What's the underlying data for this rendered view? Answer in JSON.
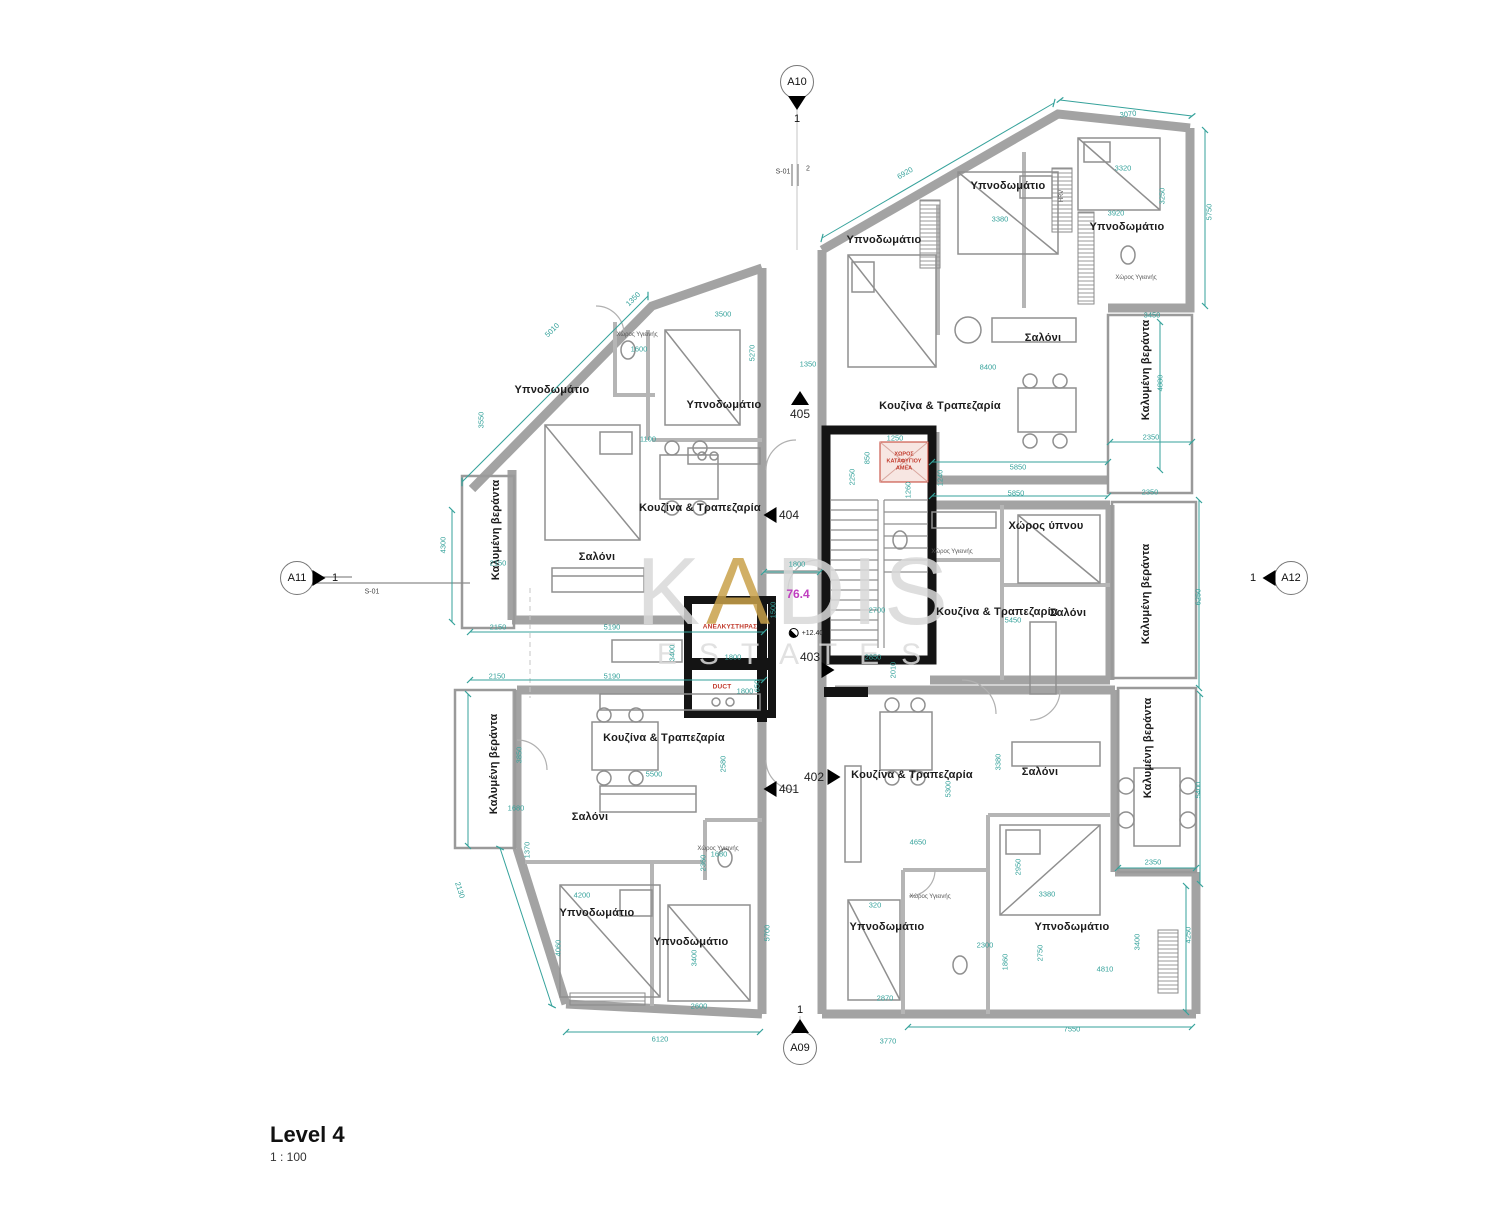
{
  "title_block": {
    "title": "Level 4",
    "scale": "1 : 100"
  },
  "watermark": {
    "l1a": "K",
    "l1b": "A",
    "l1c": "DIS",
    "line2": "ESTATES"
  },
  "area_label": {
    "value": "76.4"
  },
  "level_annotation": {
    "value": "+12.40"
  },
  "core": {
    "elevator": "ΑΝΕΛΚΥΣΤΗΡΑΣ",
    "duct": "DUCT",
    "refuge": "ΧΩΡΟΣ ΚΑΤΑΦΥΓΙΟΥ ΑΜΕΑ"
  },
  "section_markers": [
    {
      "id": "A10",
      "number": "1"
    },
    {
      "id": "A11",
      "number": "1"
    },
    {
      "id": "A12",
      "number": "1"
    },
    {
      "id": "A09",
      "number": "1"
    }
  ],
  "section_labels": {
    "top": "S-01",
    "top_detail": "2",
    "left": "S-01"
  },
  "unit_tags": [
    {
      "number": "401"
    },
    {
      "number": "402"
    },
    {
      "number": "403"
    },
    {
      "number": "404"
    },
    {
      "number": "405"
    }
  ],
  "room_labels": [
    {
      "text": "Υπνοδωμάτιο",
      "x": 884,
      "y": 240,
      "r": 0
    },
    {
      "text": "Υπνοδωμάτιο",
      "x": 1008,
      "y": 186,
      "r": 0
    },
    {
      "text": "Υπνοδωμάτιο",
      "x": 1127,
      "y": 227,
      "r": 0
    },
    {
      "text": "Σαλόνι",
      "x": 1043,
      "y": 338,
      "r": 0
    },
    {
      "text": "Κουζίνα & Τραπεζαρία",
      "x": 940,
      "y": 406,
      "r": 0
    },
    {
      "text": "Καλυμένη βεράντα",
      "x": 1146,
      "y": 370,
      "r": -90
    },
    {
      "text": "Υπνοδωμάτιο",
      "x": 552,
      "y": 390,
      "r": 0
    },
    {
      "text": "Υπνοδωμάτιο",
      "x": 724,
      "y": 405,
      "r": 0
    },
    {
      "text": "Κουζίνα & Τραπεζαρία",
      "x": 700,
      "y": 508,
      "r": 0
    },
    {
      "text": "Σαλόνι",
      "x": 597,
      "y": 557,
      "r": 0
    },
    {
      "text": "Καλυμένη βεράντα",
      "x": 496,
      "y": 530,
      "r": -90
    },
    {
      "text": "Χώρος ύπνου",
      "x": 1046,
      "y": 526,
      "r": 0
    },
    {
      "text": "Κουζίνα & Τραπεζαρία",
      "x": 997,
      "y": 612,
      "r": 0
    },
    {
      "text": "Σαλόνι",
      "x": 1068,
      "y": 613,
      "r": 0
    },
    {
      "text": "Καλυμένη βεράντα",
      "x": 1146,
      "y": 594,
      "r": -90
    },
    {
      "text": "Κουζίνα & Τραπεζαρία",
      "x": 664,
      "y": 738,
      "r": 0
    },
    {
      "text": "Σαλόνι",
      "x": 590,
      "y": 817,
      "r": 0
    },
    {
      "text": "Καλυμένη βεράντα",
      "x": 494,
      "y": 764,
      "r": -90
    },
    {
      "text": "Υπνοδωμάτιο",
      "x": 597,
      "y": 913,
      "r": 0
    },
    {
      "text": "Υπνοδωμάτιο",
      "x": 691,
      "y": 942,
      "r": 0
    },
    {
      "text": "Κουζίνα & Τραπεζαρία",
      "x": 912,
      "y": 775,
      "r": 0
    },
    {
      "text": "Σαλόνι",
      "x": 1040,
      "y": 772,
      "r": 0
    },
    {
      "text": "Καλυμένη βεράντα",
      "x": 1148,
      "y": 748,
      "r": -90
    },
    {
      "text": "Υπνοδωμάτιο",
      "x": 887,
      "y": 927,
      "r": 0
    },
    {
      "text": "Υπνοδωμάτιο",
      "x": 1072,
      "y": 927,
      "r": 0
    }
  ],
  "small_labels": [
    {
      "text": "Χώρος Υγιεινής",
      "x": 637,
      "y": 335,
      "r": 0
    },
    {
      "text": "Χώρος Υγιεινής",
      "x": 1136,
      "y": 278,
      "r": 0
    },
    {
      "text": "Χώρος Υγιεινής",
      "x": 952,
      "y": 552,
      "r": 0
    },
    {
      "text": "Χώρος Υγιεινής",
      "x": 718,
      "y": 849,
      "r": 0
    },
    {
      "text": "Χώρος Υγιεινής",
      "x": 930,
      "y": 897,
      "r": 0
    },
    {
      "text": "HRV",
      "x": 1062,
      "y": 196,
      "r": -90
    }
  ],
  "dimensions": [
    {
      "value": "3070",
      "x": 1128,
      "y": 114,
      "r": -7
    },
    {
      "value": "6920",
      "x": 905,
      "y": 173,
      "r": -30
    },
    {
      "value": "3380",
      "x": 1000,
      "y": 219,
      "r": 0
    },
    {
      "value": "8400",
      "x": 988,
      "y": 367,
      "r": 0
    },
    {
      "value": "1350",
      "x": 808,
      "y": 364,
      "r": 0
    },
    {
      "value": "3500",
      "x": 723,
      "y": 314,
      "r": 0
    },
    {
      "value": "5270",
      "x": 752,
      "y": 353,
      "r": -90
    },
    {
      "value": "1600",
      "x": 639,
      "y": 349,
      "r": 0
    },
    {
      "value": "1100",
      "x": 648,
      "y": 439,
      "r": 0
    },
    {
      "value": "1350",
      "x": 633,
      "y": 299,
      "r": -45
    },
    {
      "value": "5010",
      "x": 552,
      "y": 330,
      "r": -45
    },
    {
      "value": "3550",
      "x": 481,
      "y": 420,
      "r": -90
    },
    {
      "value": "3320",
      "x": 1123,
      "y": 168,
      "r": 0
    },
    {
      "value": "3250",
      "x": 1162,
      "y": 196,
      "r": -90
    },
    {
      "value": "3920",
      "x": 1116,
      "y": 213,
      "r": 0
    },
    {
      "value": "5750",
      "x": 1209,
      "y": 212,
      "r": -90
    },
    {
      "value": "3450",
      "x": 1152,
      "y": 315,
      "r": 0
    },
    {
      "value": "4880",
      "x": 1160,
      "y": 383,
      "r": -90
    },
    {
      "value": "2350",
      "x": 1151,
      "y": 437,
      "r": 0
    },
    {
      "value": "2350",
      "x": 1150,
      "y": 492,
      "r": 0
    },
    {
      "value": "5850",
      "x": 1018,
      "y": 467,
      "r": 0
    },
    {
      "value": "5850",
      "x": 1016,
      "y": 493,
      "r": 0
    },
    {
      "value": "6250",
      "x": 1198,
      "y": 597,
      "r": -90
    },
    {
      "value": "5450",
      "x": 1013,
      "y": 620,
      "r": 0
    },
    {
      "value": "2700",
      "x": 877,
      "y": 610,
      "r": 0
    },
    {
      "value": "2850",
      "x": 873,
      "y": 657,
      "r": 0
    },
    {
      "value": "2010",
      "x": 893,
      "y": 670,
      "r": -90
    },
    {
      "value": "1800",
      "x": 797,
      "y": 564,
      "r": 0
    },
    {
      "value": "1800",
      "x": 733,
      "y": 657,
      "r": 0
    },
    {
      "value": "1800",
      "x": 745,
      "y": 691,
      "r": 0
    },
    {
      "value": "650",
      "x": 757,
      "y": 686,
      "r": -90
    },
    {
      "value": "1500",
      "x": 773,
      "y": 610,
      "r": -90
    },
    {
      "value": "850",
      "x": 867,
      "y": 458,
      "r": -90
    },
    {
      "value": "1250",
      "x": 895,
      "y": 438,
      "r": 0
    },
    {
      "value": "2250",
      "x": 852,
      "y": 477,
      "r": -90
    },
    {
      "value": "1260",
      "x": 908,
      "y": 490,
      "r": -90
    },
    {
      "value": "1240",
      "x": 940,
      "y": 478,
      "r": -90
    },
    {
      "value": "2150",
      "x": 498,
      "y": 563,
      "r": 0
    },
    {
      "value": "2150",
      "x": 498,
      "y": 627,
      "r": 0
    },
    {
      "value": "2150",
      "x": 497,
      "y": 676,
      "r": 0
    },
    {
      "value": "5190",
      "x": 612,
      "y": 627,
      "r": 0
    },
    {
      "value": "5190",
      "x": 612,
      "y": 676,
      "r": 0
    },
    {
      "value": "4300",
      "x": 443,
      "y": 545,
      "r": -90
    },
    {
      "value": "3400",
      "x": 672,
      "y": 653,
      "r": -90
    },
    {
      "value": "3850",
      "x": 519,
      "y": 755,
      "r": -90
    },
    {
      "value": "1680",
      "x": 516,
      "y": 808,
      "r": 0
    },
    {
      "value": "1370",
      "x": 527,
      "y": 850,
      "r": -90
    },
    {
      "value": "2130",
      "x": 460,
      "y": 890,
      "r": 72
    },
    {
      "value": "4200",
      "x": 582,
      "y": 895,
      "r": 0
    },
    {
      "value": "5500",
      "x": 654,
      "y": 774,
      "r": 0
    },
    {
      "value": "2580",
      "x": 723,
      "y": 764,
      "r": -90
    },
    {
      "value": "2360",
      "x": 703,
      "y": 863,
      "r": -90
    },
    {
      "value": "1680",
      "x": 719,
      "y": 854,
      "r": 0
    },
    {
      "value": "4060",
      "x": 558,
      "y": 948,
      "r": -90
    },
    {
      "value": "3400",
      "x": 694,
      "y": 958,
      "r": -90
    },
    {
      "value": "2600",
      "x": 699,
      "y": 1006,
      "r": 0
    },
    {
      "value": "6120",
      "x": 660,
      "y": 1039,
      "r": 0
    },
    {
      "value": "5700",
      "x": 767,
      "y": 933,
      "r": -90
    },
    {
      "value": "5300",
      "x": 948,
      "y": 789,
      "r": -90
    },
    {
      "value": "4650",
      "x": 918,
      "y": 842,
      "r": 0
    },
    {
      "value": "3380",
      "x": 998,
      "y": 762,
      "r": -90
    },
    {
      "value": "2950",
      "x": 1018,
      "y": 867,
      "r": -90
    },
    {
      "value": "3380",
      "x": 1047,
      "y": 894,
      "r": 0
    },
    {
      "value": "2300",
      "x": 985,
      "y": 945,
      "r": 0
    },
    {
      "value": "1860",
      "x": 1005,
      "y": 962,
      "r": -90
    },
    {
      "value": "2750",
      "x": 1040,
      "y": 953,
      "r": -90
    },
    {
      "value": "3400",
      "x": 1137,
      "y": 942,
      "r": -90
    },
    {
      "value": "4810",
      "x": 1105,
      "y": 969,
      "r": 0
    },
    {
      "value": "2870",
      "x": 885,
      "y": 998,
      "r": 0
    },
    {
      "value": "3770",
      "x": 888,
      "y": 1041,
      "r": 0
    },
    {
      "value": "7550",
      "x": 1072,
      "y": 1029,
      "r": 0
    },
    {
      "value": "2350",
      "x": 1153,
      "y": 862,
      "r": 0
    },
    {
      "value": "5400",
      "x": 1198,
      "y": 790,
      "r": -90
    },
    {
      "value": "4250",
      "x": 1188,
      "y": 935,
      "r": -90
    },
    {
      "value": "320",
      "x": 875,
      "y": 905,
      "r": 0
    }
  ],
  "colors": {
    "dimension": "#35a29b",
    "wall": "#a3a3a3",
    "core_wall": "#141414",
    "alert_red": "#c0392b",
    "area_magenta": "#bf3fbf",
    "watermark_gray": "#d9d9d9",
    "watermark_gold": "#c9a24b"
  }
}
